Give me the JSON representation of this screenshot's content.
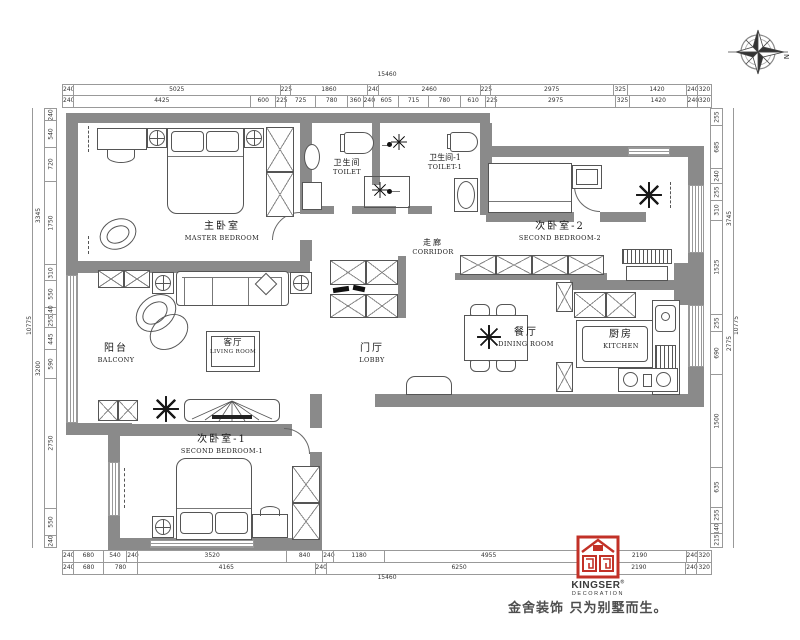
{
  "compass": {
    "north": "N"
  },
  "rooms": {
    "master": {
      "cn": "主卧室",
      "en": "MASTER BEDROOM"
    },
    "toilet": {
      "cn": "卫生间",
      "en": "TOILET"
    },
    "toilet1": {
      "cn": "卫生间-1",
      "en": "TOILET-1"
    },
    "bedroom2": {
      "cn": "次卧室-2",
      "en": "SECOND BEDROOM-2"
    },
    "corridor": {
      "cn": "走廊",
      "en": "CORRIDOR"
    },
    "balcony": {
      "cn": "阳台",
      "en": "BALCONY"
    },
    "living": {
      "cn": "客厅",
      "en": "LIVING ROOM"
    },
    "lobby": {
      "cn": "门厅",
      "en": "LOBBY"
    },
    "dining": {
      "cn": "餐厅",
      "en": "DINING ROOM"
    },
    "kitchen": {
      "cn": "厨房",
      "en": "KITCHEN"
    },
    "bedroom1": {
      "cn": "次卧室-1",
      "en": "SECOND BEDROOM-1"
    }
  },
  "dims": {
    "top_total": "15460",
    "top_row1": [
      "240",
      "5025",
      "225",
      "1860",
      "240",
      "2460",
      "225",
      "2975",
      "325",
      "1420",
      "240",
      "320"
    ],
    "top_row2": [
      "240",
      "4425",
      "600",
      "225",
      "725",
      "780",
      "360",
      "240",
      "605",
      "715",
      "780",
      "610",
      "225",
      "2975",
      "325",
      "1420",
      "240",
      "320"
    ],
    "left_total": "10775",
    "left_groups": [
      "3345",
      "3200"
    ],
    "left_col": [
      "240",
      "540",
      "720",
      "1750",
      "310",
      "550",
      "140",
      "255",
      "445",
      "590",
      "2750",
      "550",
      "240"
    ],
    "right_total": "10775",
    "right_groups": [
      "3745",
      "2775"
    ],
    "right_col": [
      "255",
      "685",
      "240",
      "255",
      "310",
      "1525",
      "255",
      "690",
      "1500",
      "635",
      "255",
      "140",
      "215"
    ],
    "bottom_total": "15460",
    "bottom_row1": [
      "240",
      "680",
      "540",
      "240",
      "3520",
      "840",
      "240",
      "1180",
      "4955",
      "2190",
      "240",
      "320"
    ],
    "bottom_row2": [
      "240",
      "680",
      "780",
      "4165",
      "240",
      "6250",
      "2190",
      "240",
      "320"
    ]
  },
  "logo": {
    "brand": "KINGSER",
    "reg": "®",
    "subtitle": "DECORATION",
    "slogan": "金舍装饰 只为别墅而生。"
  },
  "colors": {
    "wall": "#8a8a8a",
    "line": "#555555",
    "dim": "#333333",
    "red": "#c23127"
  }
}
